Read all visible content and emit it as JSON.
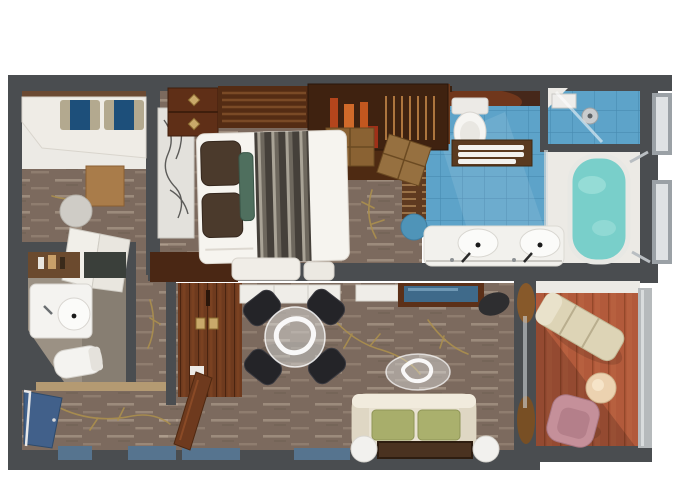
{
  "scene": {
    "type": "floor-plan",
    "description": "Top-down 3D rendered floor plan of a suite: bedroom, master bathroom, guest WC, dressing area, living-dining room and private balcony",
    "rooms": [
      {
        "name": "dressing-room",
        "furniture": [
          "window-bench",
          "striped-pillow",
          "striped-pillow",
          "wood-side-table",
          "round-stool",
          "mirrored-closet-doors"
        ]
      },
      {
        "name": "bedroom",
        "furniture": [
          "double-bed",
          "striped-runner",
          "bed-pillows",
          "headboard-art",
          "nightstand",
          "headboard-shelf",
          "tall-cabinet",
          "display-cabinet-with-vases",
          "storage-chests",
          "foot-cushions",
          "low-dresser"
        ]
      },
      {
        "name": "master-bathroom",
        "furniture": [
          "double-sink-vanity",
          "toilet",
          "towel-mat",
          "soaking-tub",
          "shower-room",
          "teal-stool"
        ]
      },
      {
        "name": "guest-wc",
        "furniture": [
          "corner-sink",
          "toilet",
          "shelf-with-bottles",
          "dark-counter"
        ]
      },
      {
        "name": "hallway-entry",
        "furniture": [
          "entry-door",
          "open-interior-door",
          "wardrobe"
        ]
      },
      {
        "name": "living-dining-room",
        "furniture": [
          "glass-dining-table",
          "dining-chair",
          "dining-chair",
          "dining-chair",
          "dining-chair",
          "white-dresser",
          "white-cabinet",
          "desk-with-blue-top",
          "desk-chair",
          "glass-coffee-table",
          "loveseat-sofa",
          "green-cushion",
          "green-cushion",
          "side-table",
          "side-table",
          "rug"
        ]
      },
      {
        "name": "balcony",
        "furniture": [
          "lounge-chair",
          "round-table",
          "pink-chair",
          "railing"
        ]
      }
    ]
  },
  "palette": {
    "wall": "#4a4d50",
    "wall_light": "#b6babc",
    "carpet": "#7c6a5e",
    "deck": "#b25a3b",
    "tile": "#5da3c9",
    "tub_water": "#79cfca",
    "white_floor": "#eceae5",
    "cream": "#e9e2d2",
    "green": "#a8ae6b",
    "pink": "#c5909a",
    "door_blue": "#41608a",
    "window_blue": "#56748f",
    "teal_stool": "#4f94b8",
    "wood_red": "#6e3a1e",
    "wood_dark": "#5f2f17",
    "gray_floor": "#9b9184",
    "gold": "#ab8f4e",
    "black_chair": "#242428",
    "orange_vase": "#c2571f"
  }
}
